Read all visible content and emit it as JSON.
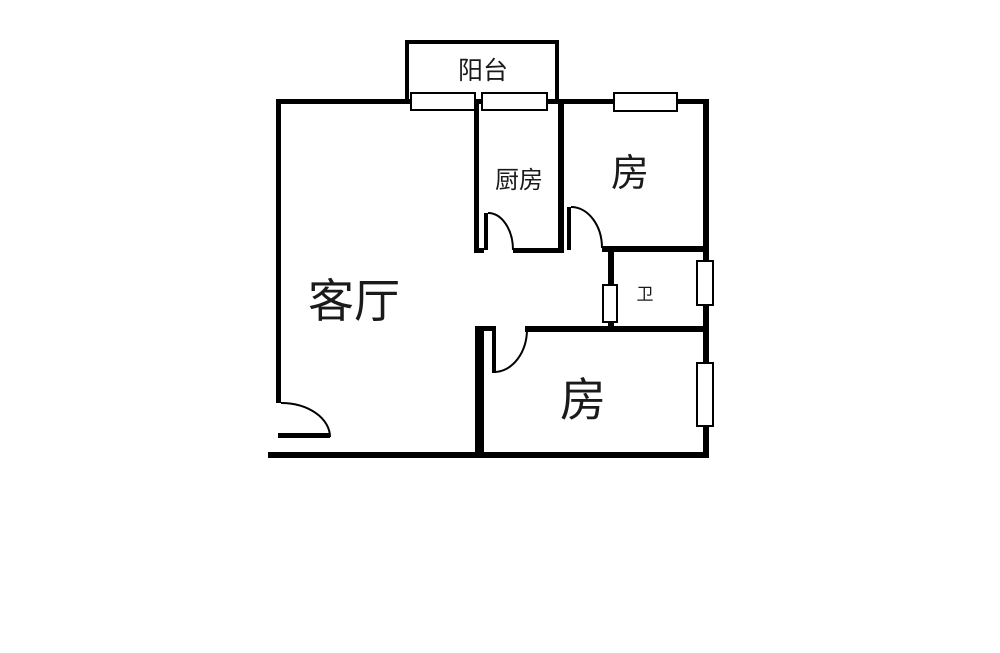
{
  "floorplan": {
    "background_color": "#ffffff",
    "wall_color": "#000000",
    "rooms": {
      "balcony": {
        "label": "阳台"
      },
      "kitchen": {
        "label": "厨房"
      },
      "bedroom_top_right": {
        "label": "房"
      },
      "living_room": {
        "label": "客厅"
      },
      "bathroom": {
        "label": "卫"
      },
      "bedroom_bottom_right": {
        "label": "房"
      }
    },
    "window_count": "6",
    "door_count": "4"
  }
}
